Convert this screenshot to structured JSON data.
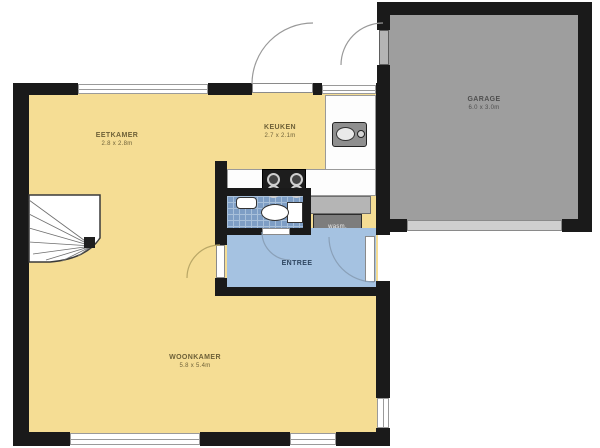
{
  "plan_title": "ground-floor-plan",
  "rooms": {
    "dining": {
      "name": "EETKAMER",
      "dims": "2.8 x 2.8m"
    },
    "kitchen": {
      "name": "KEUKEN",
      "dims": "2.7 x 2.1m"
    },
    "living": {
      "name": "WOONKAMER",
      "dims": "5.8 x 5.4m"
    },
    "garage": {
      "name": "GARAGE",
      "dims": "6.0 x 3.0m"
    },
    "hall": {
      "name": "ENTREE"
    },
    "utility": {
      "appliance_label": "wasm."
    }
  },
  "icons": {
    "stairs": "winder-staircase-top-view",
    "toilet": "toilet-top-view",
    "washbasin": "washbasin-top-view",
    "sink": "kitchen-sink-top-view",
    "cooktop": "four-burner-cooktop",
    "doors": "door-swing-arcs",
    "garage_door": "sectional-garage-door"
  },
  "colors": {
    "wall": "#1a1a1a",
    "room_yellow": "#f5dd94",
    "garage_gray": "#9e9e9e",
    "bath_tile": "#7e9ec5",
    "bath_grid": "#a8c0da",
    "hall_blue": "#a5c2e1",
    "counter_gray": "#b5b5b5",
    "appliance_dark": "#7d7d7d",
    "arc_gray": "#999999"
  }
}
